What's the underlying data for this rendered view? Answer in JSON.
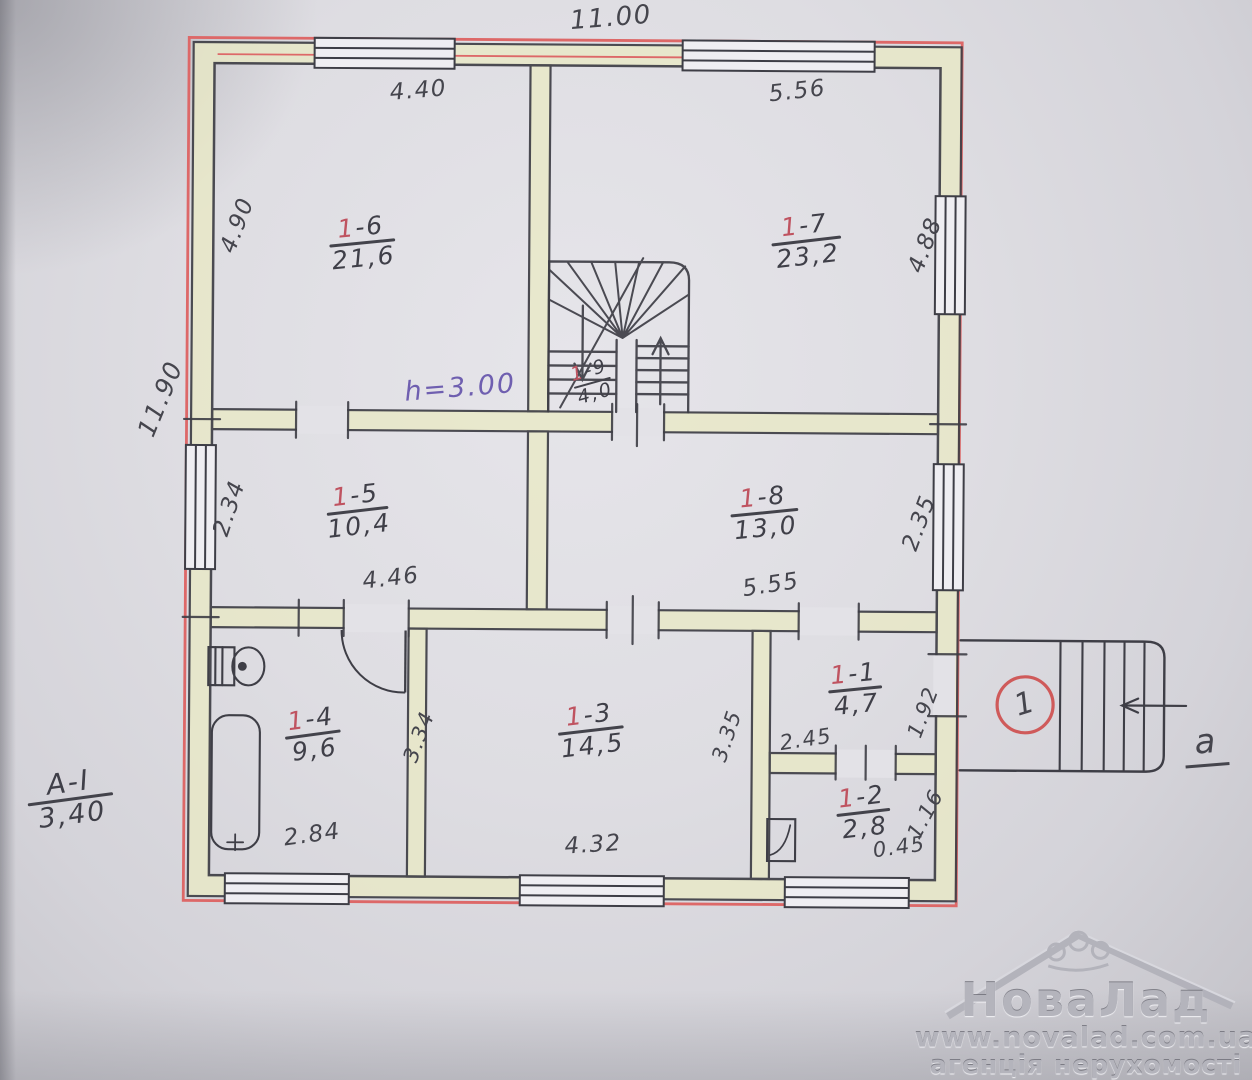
{
  "rooms": {
    "r6": {
      "accent": "1",
      "rest": "-6",
      "area": "21,6"
    },
    "r7": {
      "accent": "1",
      "rest": "-7",
      "area": "23,2"
    },
    "r5": {
      "accent": "1",
      "rest": "-5",
      "area": "10,4"
    },
    "r8": {
      "accent": "1",
      "rest": "-8",
      "area": "13,0"
    },
    "r4": {
      "accent": "1",
      "rest": "-4",
      "area": "9,6"
    },
    "r3": {
      "accent": "1",
      "rest": "-3",
      "area": "14,5"
    },
    "r1": {
      "accent": "1",
      "rest": "-1",
      "area": "4,7"
    },
    "r2": {
      "accent": "1",
      "rest": "-2",
      "area": "2,8"
    },
    "r9": {
      "accent": "1",
      "rest": "-9",
      "area": "4,0"
    }
  },
  "dims": {
    "top_width": "11.00",
    "left_height": "11.90",
    "room6_width": "4.40",
    "room7_width": "5.56",
    "room6_height": "4.90",
    "room7_height": "4.88",
    "room5_height": "2.34",
    "room8_height": "2.35",
    "room5_width": "4.46",
    "room8_width": "5.55",
    "room4_width": "2.84",
    "room4_height": "3.34",
    "room3_width": "4.32",
    "room3_height": "3.35",
    "room1_width": "2.45",
    "room1_height": "1.92",
    "room2_width": "0.45",
    "room2_height": "1.16"
  },
  "annotations": {
    "ceiling_height": "h=3.00",
    "section_mark": "А-І",
    "section_value": "3,40",
    "entrance_number": "1",
    "porch_letter": "а"
  },
  "watermark": {
    "brand": "НоваЛад",
    "url": "www.novalad.com.ua",
    "tagline": "агенція нерухомості"
  },
  "colors": {
    "wall_fill": "#e8e8c6",
    "outline_red": "#dd6868",
    "ink": "#3e3e46",
    "label_red": "#bf5360",
    "note_purple": "#6f5fb0"
  }
}
